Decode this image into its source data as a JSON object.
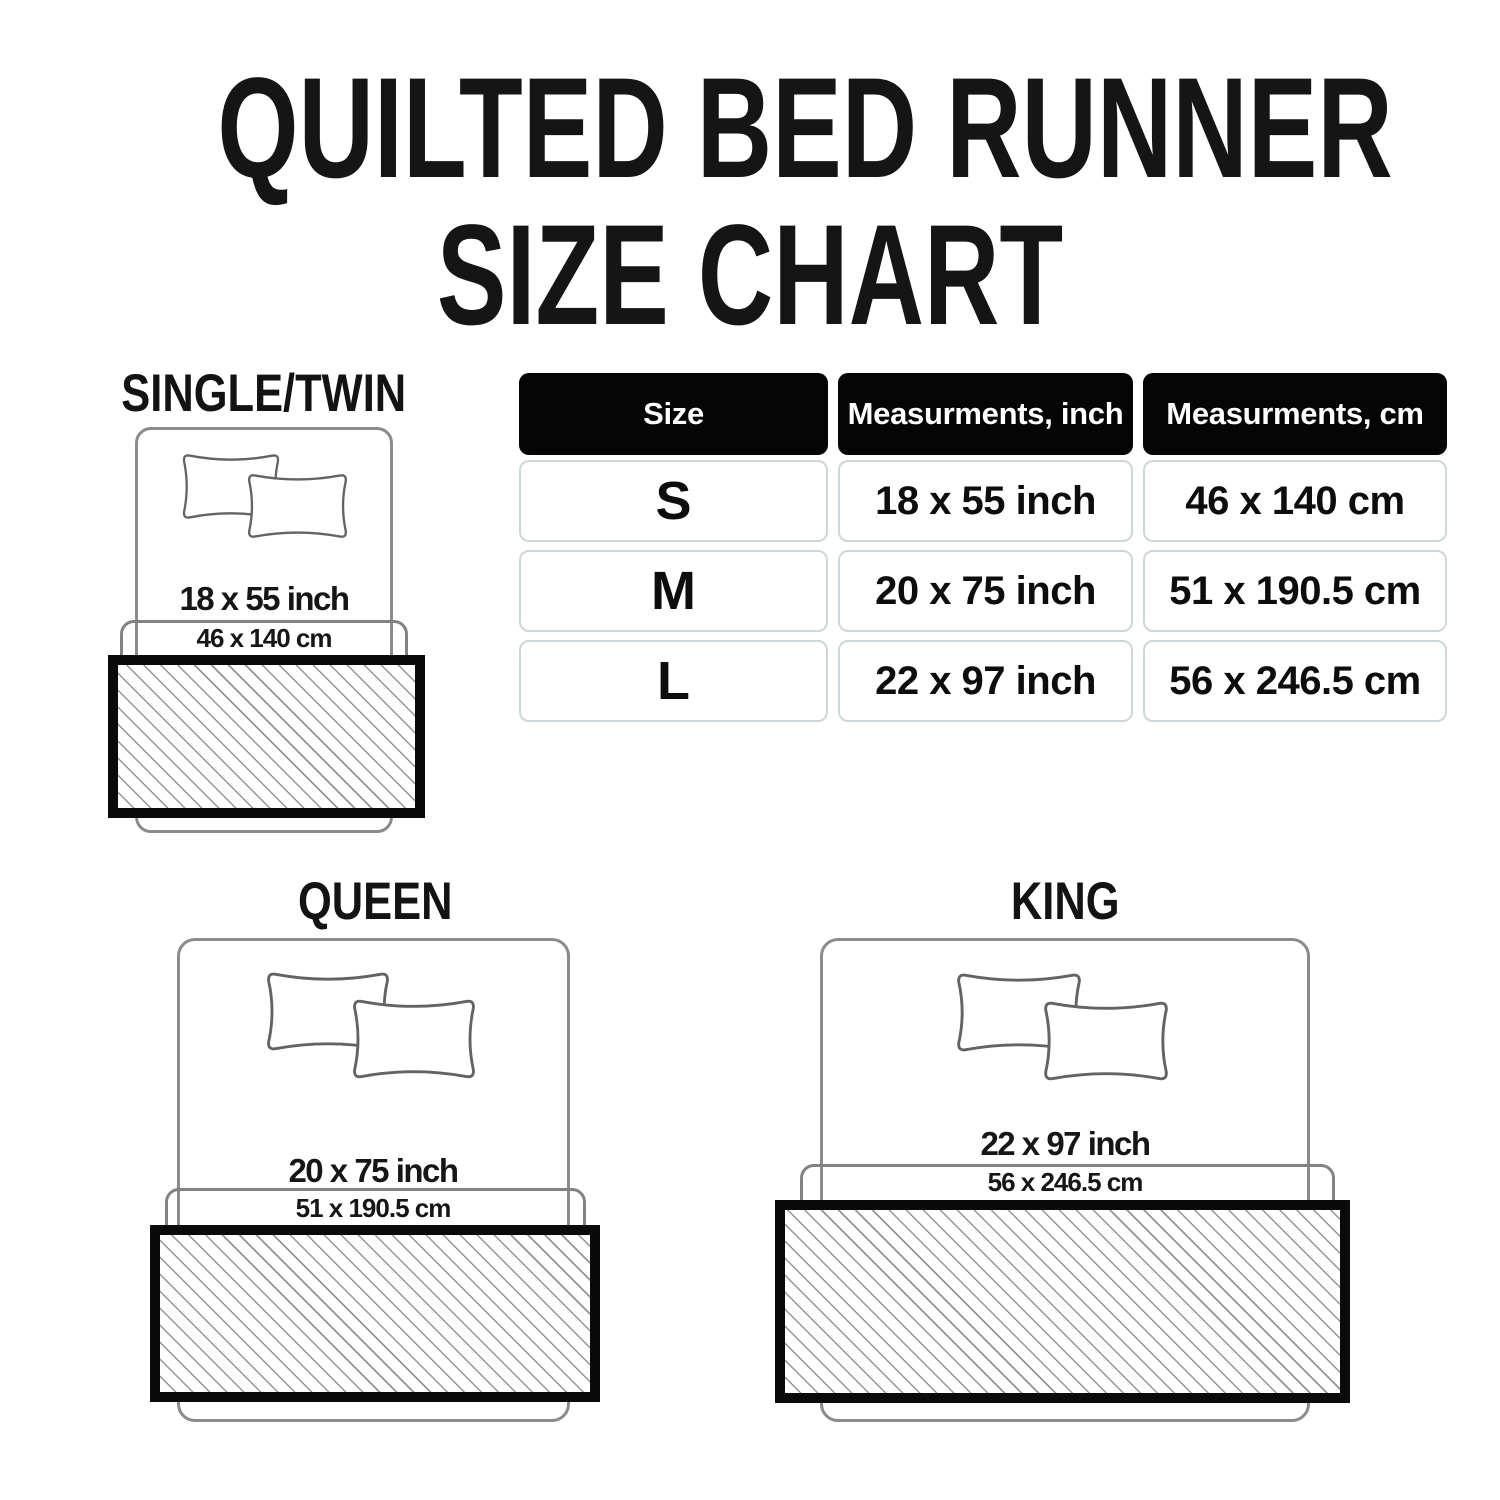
{
  "title": {
    "line1": "QUILTED BED RUNNER",
    "line2": "SIZE CHART"
  },
  "table": {
    "headers": [
      "Size",
      "Measurments, inch",
      "Measurments, cm"
    ],
    "rows": [
      {
        "size": "S",
        "inch": "18 x 55 inch",
        "cm": "46 x 140 cm"
      },
      {
        "size": "M",
        "inch": "20 x 75 inch",
        "cm": "51 x 190.5 cm"
      },
      {
        "size": "L",
        "inch": "22 x 97 inch",
        "cm": "56 x 246.5 cm"
      }
    ]
  },
  "diagrams": [
    {
      "label": "SINGLE/TWIN",
      "inch": "18 x 55 inch",
      "cm": "46 x 140 cm"
    },
    {
      "label": "QUEEN",
      "inch": "20 x 75 inch",
      "cm": "51 x 190.5 cm"
    },
    {
      "label": "KING",
      "inch": "22 x 97 inch",
      "cm": "56 x 246.5 cm"
    }
  ],
  "colors": {
    "header_bg": "#050505",
    "header_text": "#ffffff",
    "cell_border": "#cbd7d9",
    "runner_border": "#0a0a0a",
    "hatch_line": "#949494",
    "outline_gray": "#8b8b8b",
    "text": "#141414"
  },
  "chart_data": {
    "type": "table",
    "title": "QUILTED BED RUNNER SIZE CHART",
    "columns": [
      "Size",
      "Measurments, inch",
      "Measurments, cm"
    ],
    "rows": [
      [
        "S",
        "18 x 55 inch",
        "46 x 140 cm"
      ],
      [
        "M",
        "20 x 75 inch",
        "51 x 190.5 cm"
      ],
      [
        "L",
        "22 x 97 inch",
        "56 x 246.5 cm"
      ]
    ],
    "bed_sizes": [
      {
        "name": "SINGLE/TWIN",
        "runner_inch": "18 x 55 inch",
        "runner_cm": "46 x 140 cm"
      },
      {
        "name": "QUEEN",
        "runner_inch": "20 x 75 inch",
        "runner_cm": "51 x 190.5 cm"
      },
      {
        "name": "KING",
        "runner_inch": "22 x 97 inch",
        "runner_cm": "56 x 246.5 cm"
      }
    ]
  }
}
